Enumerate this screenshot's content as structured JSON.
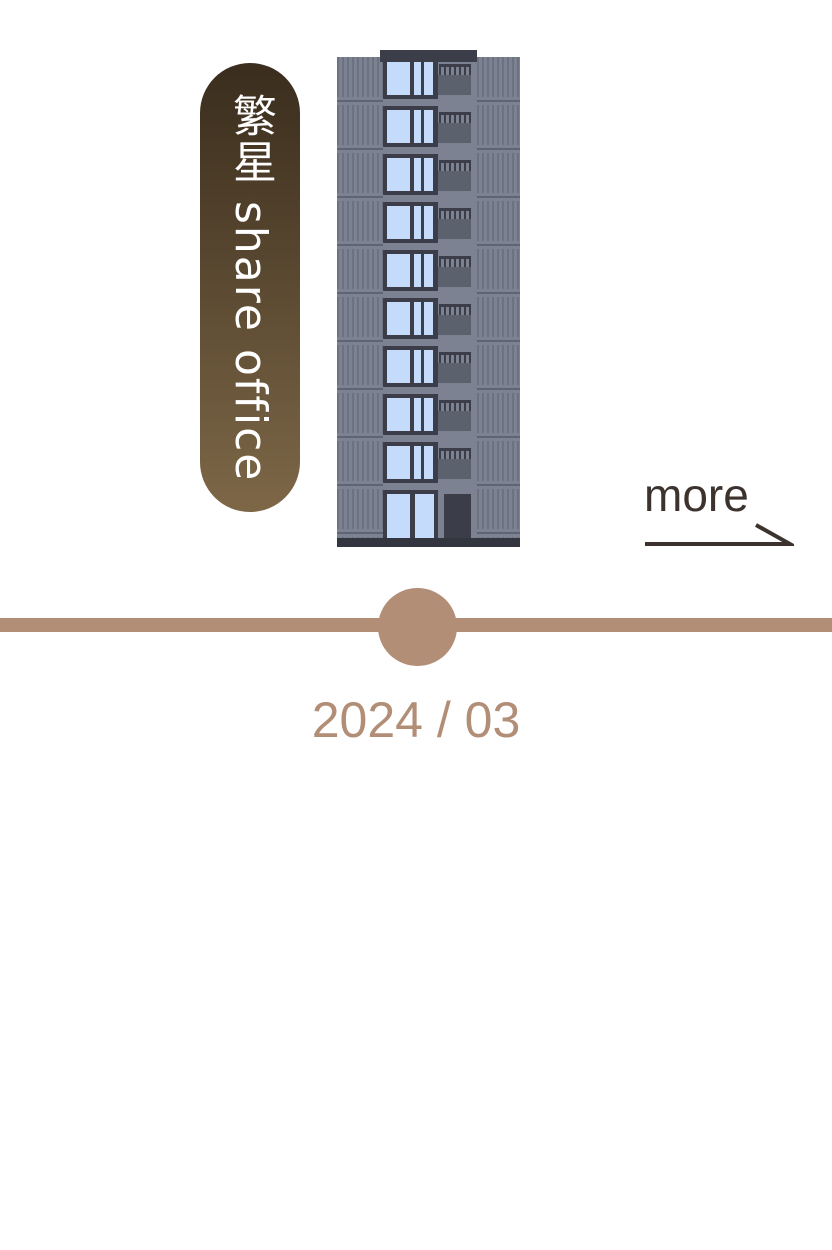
{
  "badge": {
    "label": "繁星 share office"
  },
  "building": {
    "name": "office-building-illustration",
    "upper_floors": 9
  },
  "more_link": {
    "label": "more"
  },
  "timeline": {
    "date": "2024 / 03"
  },
  "colors": {
    "badge-top": "#3a2d1d",
    "badge-bottom": "#7d6747",
    "badge-text": "#ffffff",
    "bbody": "#7d8292",
    "bstripe": "#6d7280",
    "bfloorline": "#5f6474",
    "bframe": "#3b3e48",
    "bglass": "#c5dbfb",
    "bpanel": "#5c616e",
    "bbase": "#33363f",
    "more-text": "#3d332e",
    "timeline": "#b28e77"
  }
}
